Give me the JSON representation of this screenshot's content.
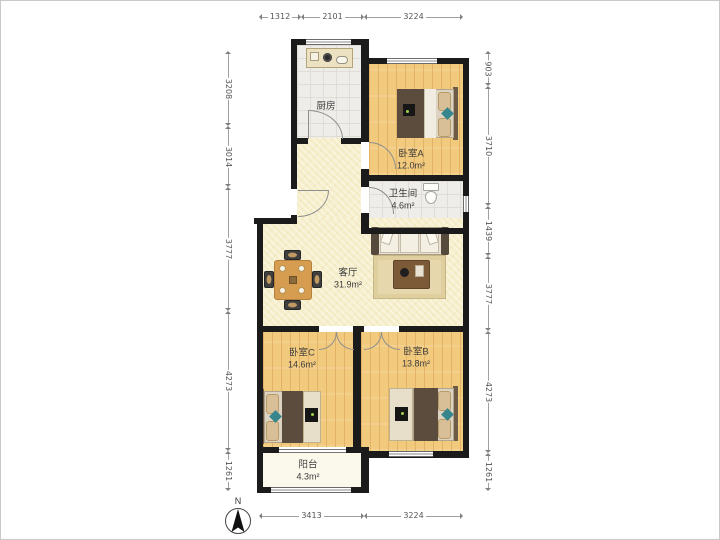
{
  "rooms": {
    "kitchen": {
      "name": "厨房"
    },
    "bedroom_a": {
      "name": "卧室A",
      "area": "12.0m²"
    },
    "bathroom": {
      "name": "卫生间",
      "area": "4.6m²"
    },
    "living_room": {
      "name": "客厅",
      "area": "31.9m²"
    },
    "bedroom_c": {
      "name": "卧室C",
      "area": "14.6m²"
    },
    "bedroom_b": {
      "name": "卧室B",
      "area": "13.8m²"
    },
    "balcony": {
      "name": "阳台",
      "area": "4.3m²"
    }
  },
  "dimensions_mm": {
    "top": [
      "1312",
      "2101",
      "3224"
    ],
    "bottom": [
      "3413",
      "3224"
    ],
    "left": [
      "3208",
      "3014",
      "3777",
      "4273",
      "1261"
    ],
    "right": [
      "903",
      "3710",
      "1439",
      "3777",
      "4273",
      "1261"
    ]
  },
  "compass": {
    "label": "N"
  },
  "colors": {
    "wall": "#1b1b1b",
    "wood_floor": "#f2ca7e",
    "wood_line": "#e2b266",
    "living_floor": "#f6eeca",
    "tile_floor": "#eeede9",
    "tile_line": "#dfddd6",
    "balcony_floor": "#fbf8ec",
    "blanket": "#5b4c3d",
    "pillow": "#d9bf97",
    "teal_accent": "#37858d",
    "dim_line": "#a0a0a0",
    "dim_text": "#555555",
    "label_text": "#3c3c3c"
  }
}
